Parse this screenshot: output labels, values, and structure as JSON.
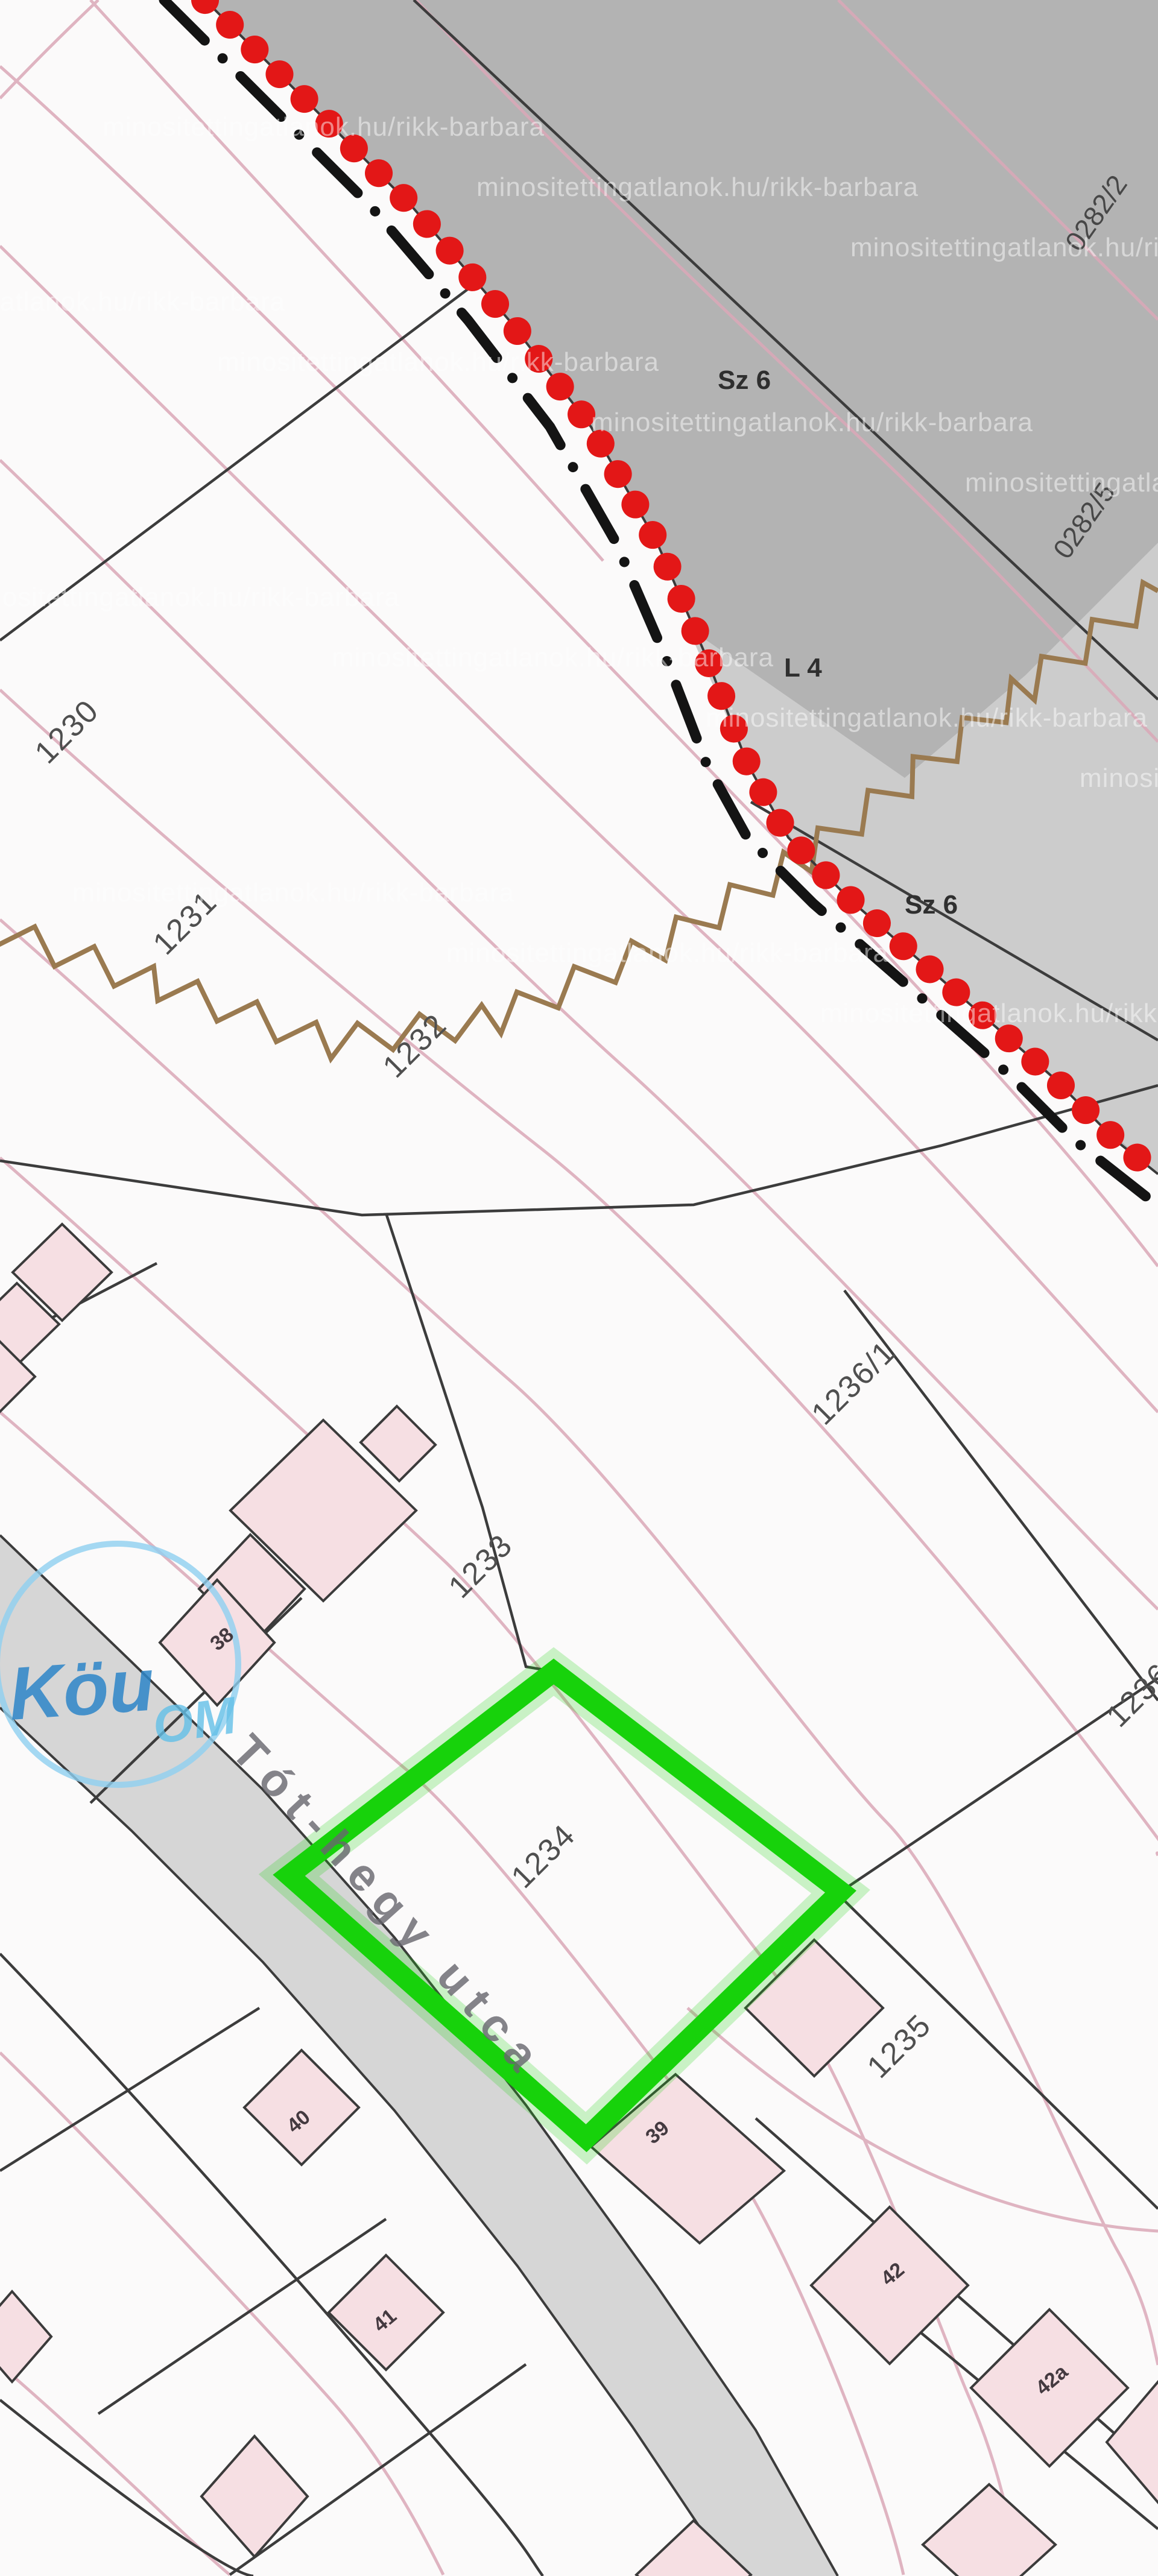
{
  "map": {
    "title": "cadastral-map",
    "street": {
      "name": "Tót-hegy utca"
    },
    "stamp": {
      "line1": "Köu",
      "line2": "OM"
    },
    "watermark": {
      "text": "minositettingatlanok.hu/rikk-barbara"
    },
    "highlight": {
      "parcel": "1234",
      "color": "#17d20b"
    },
    "parcels": {
      "p0282_2": "0282/2",
      "p0282_5": "0282/5",
      "p1230": "1230",
      "p1231": "1231",
      "p1232": "1232",
      "p1233": "1233",
      "p1234": "1234",
      "p1235": "1235",
      "p1236_1": "1236/1",
      "p1236_2": "1236/2"
    },
    "land_use": {
      "sz6_a": "Sz 6",
      "sz6_b": "Sz 6",
      "l4": "L 4"
    },
    "house_numbers": {
      "h38": "38",
      "h39": "39",
      "h40": "40",
      "h41": "41",
      "h42": "42",
      "h42a": "42a"
    },
    "colors": {
      "boundary_dots": "#e31717",
      "admin_dash": "#141414",
      "forest_gray": "#b3b3b3",
      "forest_gray_light": "#cccccc",
      "street_gray": "#d6d6d6",
      "contour_pink": "#dba8b8",
      "zigzag_brown": "#9a7a50",
      "building_pink": "#f6dfe3",
      "parcel_line": "#3c3c3c",
      "stamp_blue": "#8fd0f0"
    }
  }
}
